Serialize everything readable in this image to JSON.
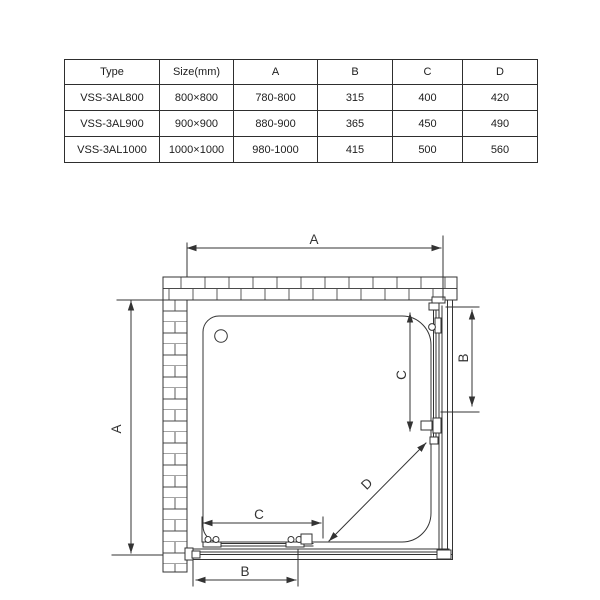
{
  "table": {
    "headers": [
      "Type",
      "Size(mm)",
      "A",
      "B",
      "C",
      "D"
    ],
    "rows": [
      [
        "VSS-3AL800",
        "800×800",
        "780-800",
        "315",
        "400",
        "420"
      ],
      [
        "VSS-3AL900",
        "900×900",
        "880-900",
        "365",
        "450",
        "490"
      ],
      [
        "VSS-3AL1000",
        "1000×1000",
        "980-1000",
        "415",
        "500",
        "560"
      ]
    ]
  },
  "drawing": {
    "line_color": "#333333",
    "labels": {
      "a_top": "A",
      "a_left": "A",
      "b_right": "B",
      "c_right": "C",
      "c_bottom": "C",
      "b_bottom": "B",
      "d_diagonal": "D"
    }
  }
}
